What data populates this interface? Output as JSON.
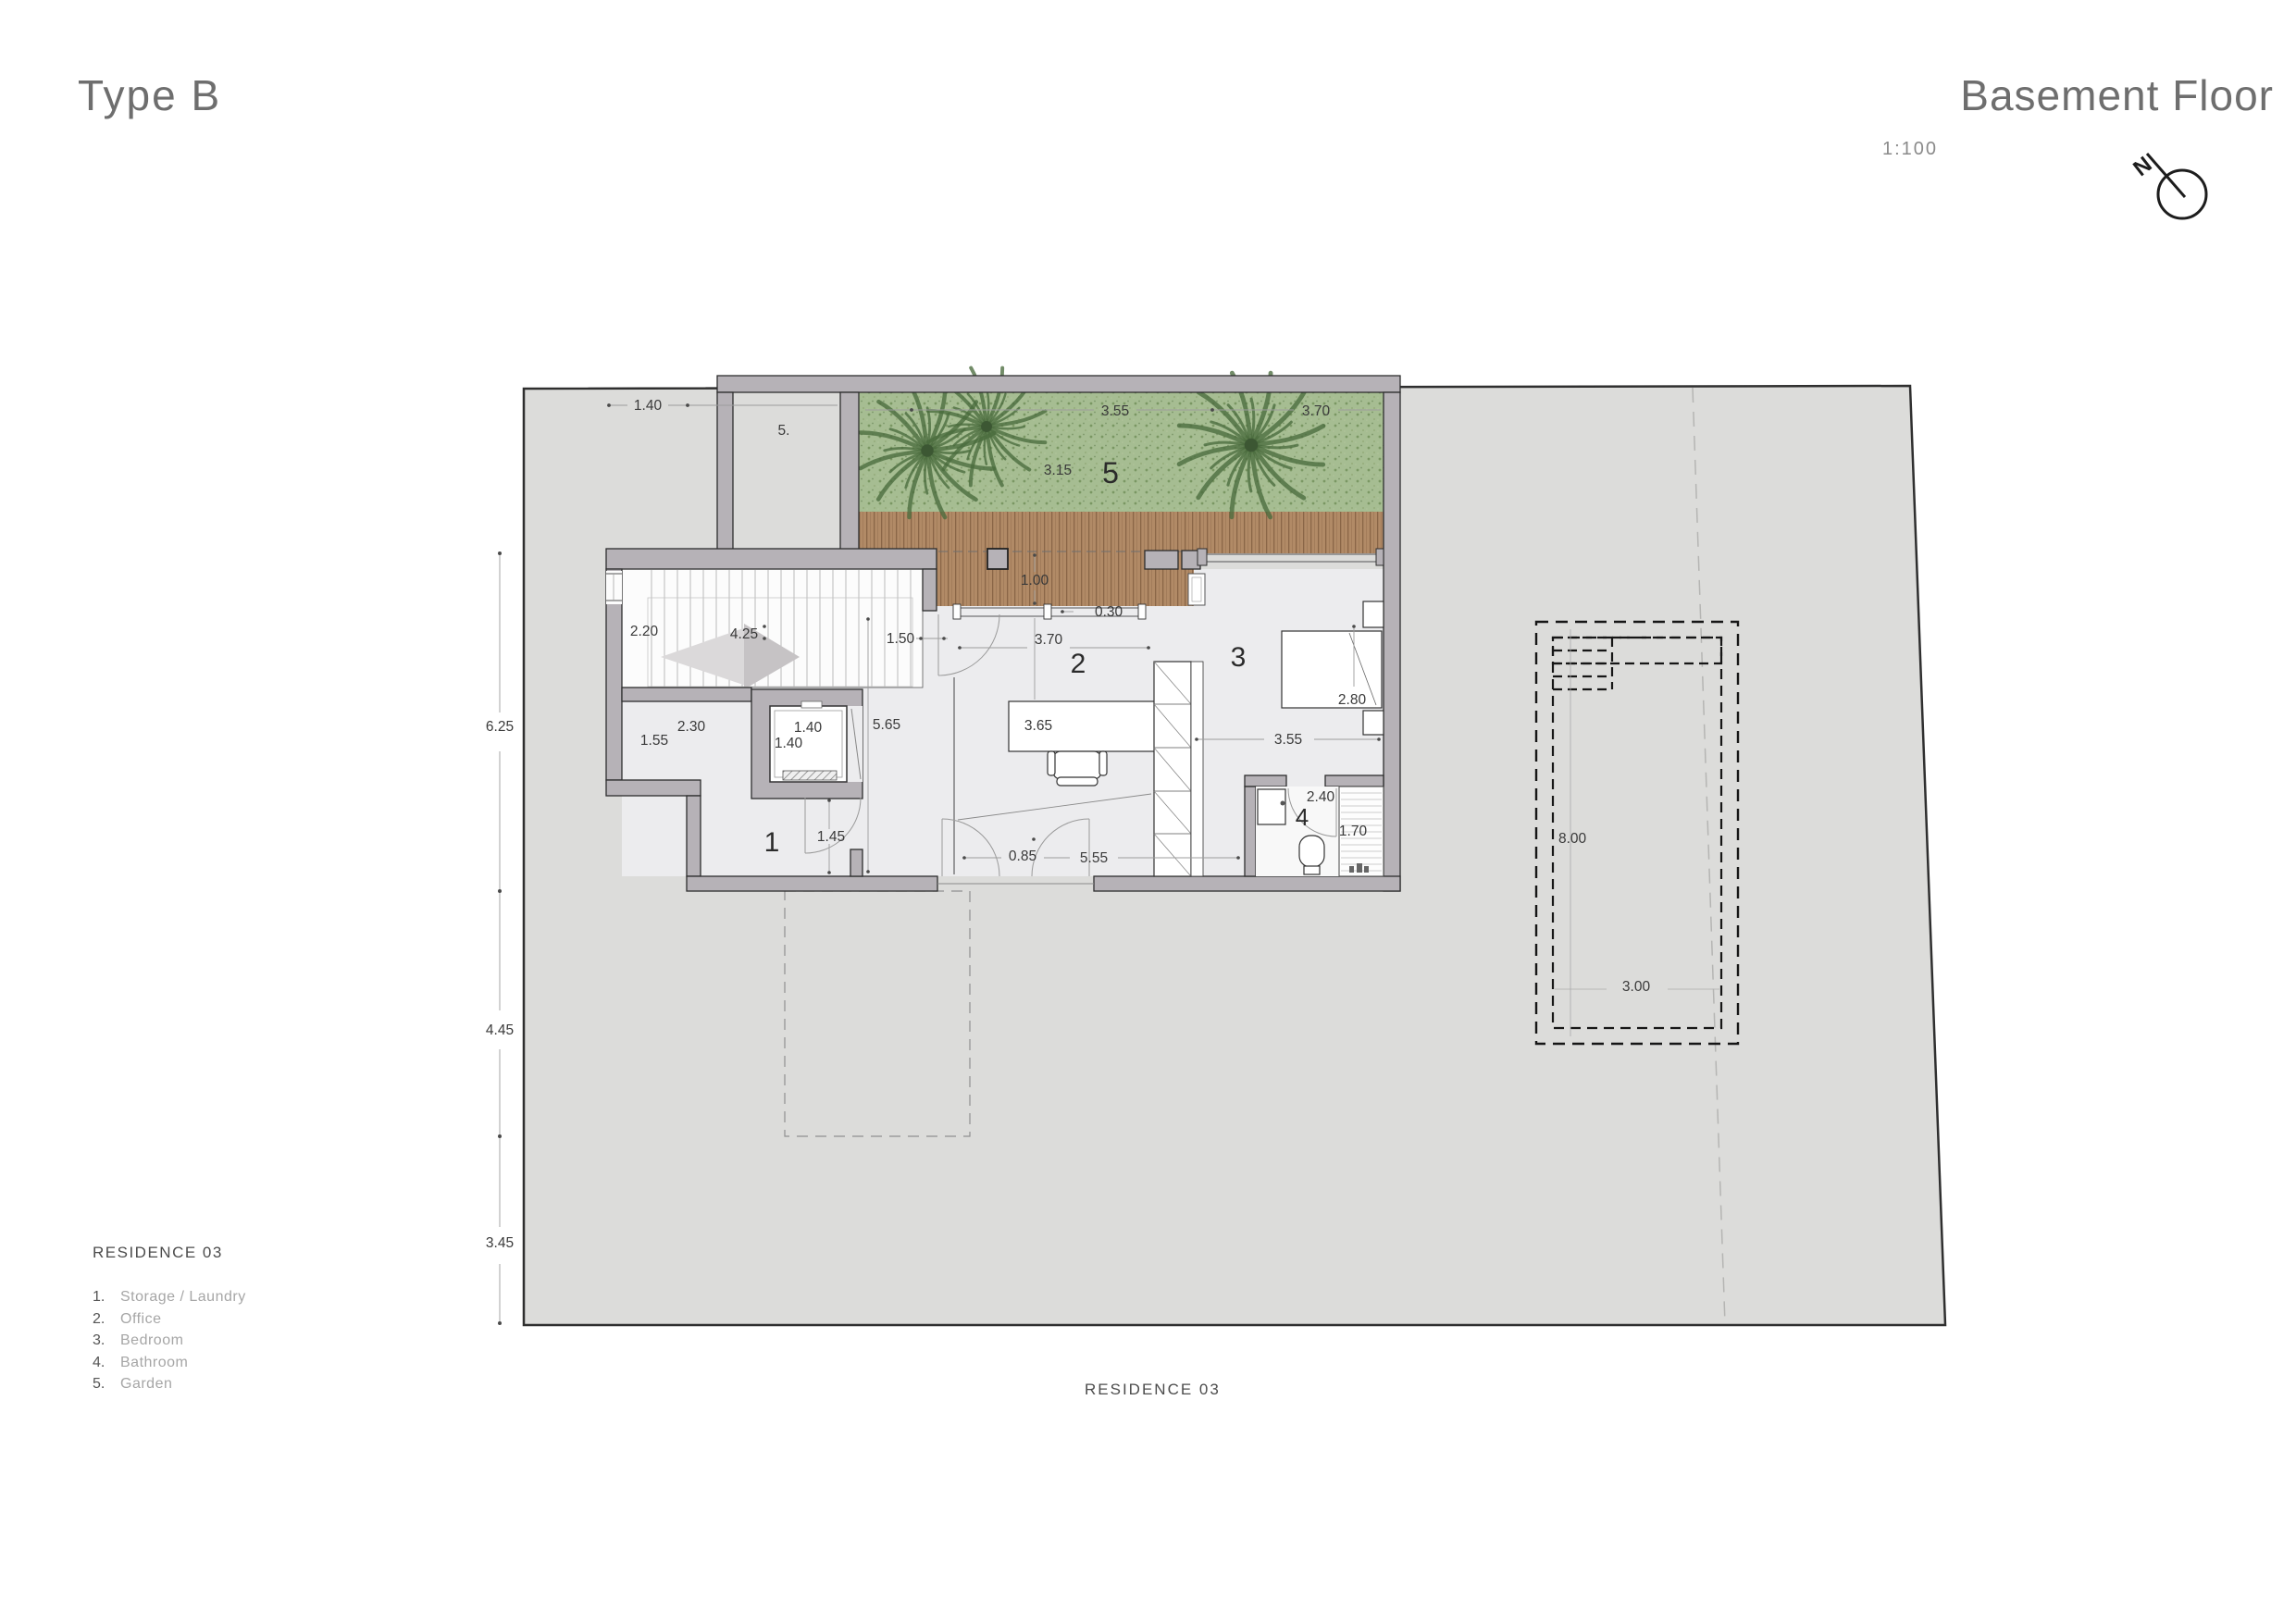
{
  "header": {
    "type_title": "Type B",
    "floor_title": "Basement Floor",
    "scale": "1:100",
    "north": "N"
  },
  "legend": {
    "title": "RESIDENCE 03",
    "items": [
      {
        "num": "1.",
        "label": "Storage / Laundry"
      },
      {
        "num": "2.",
        "label": "Office"
      },
      {
        "num": "3.",
        "label": "Bedroom"
      },
      {
        "num": "4.",
        "label": "Bathroom"
      },
      {
        "num": "5.",
        "label": "Garden"
      }
    ]
  },
  "footer": {
    "caption": "RESIDENCE 03"
  },
  "rooms": {
    "r1": "1",
    "r2": "2",
    "r3": "3",
    "r4": "4",
    "r5": "5"
  },
  "dims": {
    "top_140": "1.40",
    "top_5": "5.",
    "garden_355": "3.55",
    "garden_370": "3.70",
    "garden_315": "3.15",
    "deck_100": "1.00",
    "deck_030": "0.30",
    "stairs_220": "2.20",
    "stairs_425": "4.25",
    "hall_150": "1.50",
    "hall_565": "5.65",
    "store_230": "2.30",
    "store_155": "1.55",
    "store_145": "1.45",
    "lift_140a": "1.40",
    "lift_140b": "1.40",
    "office_370": "3.70",
    "office_365": "3.65",
    "bed_280": "2.80",
    "bed_355": "3.55",
    "bath_240": "2.40",
    "bath_170": "1.70",
    "low_085": "0.85",
    "low_555": "5.55",
    "site_625": "6.25",
    "site_445": "4.45",
    "site_345": "3.45",
    "pool_800": "8.00",
    "pool_300": "3.00"
  },
  "colors": {
    "site": "#dcdcda",
    "wall": "#b6b2b7",
    "grass": "#a3bc8f",
    "deck": "#b08a66",
    "outline": "#2e2e2e",
    "dim_text": "#3a3a3a",
    "title_text": "#6e6e6e",
    "legend_muted": "#a6a6a6"
  }
}
